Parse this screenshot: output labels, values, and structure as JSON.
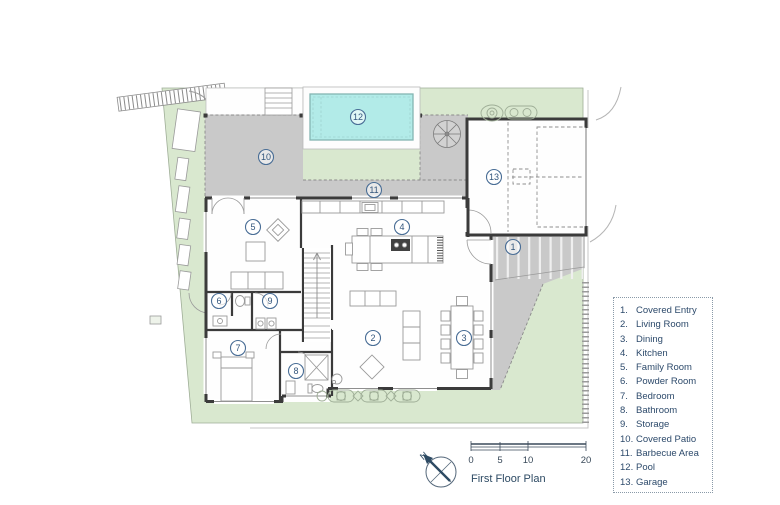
{
  "title": "First Floor Plan",
  "north_label": "N",
  "scalebar": {
    "ticks": [
      "0",
      "5",
      "10",
      "20"
    ]
  },
  "plan": {
    "labels": [
      {
        "number": "1",
        "name": "Covered Entry"
      },
      {
        "number": "2",
        "name": "Living Room"
      },
      {
        "number": "3",
        "name": "Dining"
      },
      {
        "number": "4",
        "name": "Kitchen"
      },
      {
        "number": "5",
        "name": "Family Room"
      },
      {
        "number": "6",
        "name": "Powder Room"
      },
      {
        "number": "7",
        "name": "Bedroom"
      },
      {
        "number": "8",
        "name": "Bathroom"
      },
      {
        "number": "9",
        "name": "Storage"
      },
      {
        "number": "10",
        "name": "Covered Patio"
      },
      {
        "number": "11",
        "name": "Barbecue Area"
      },
      {
        "number": "12",
        "name": "Pool"
      },
      {
        "number": "13",
        "name": "Garage"
      }
    ]
  },
  "legend": {
    "items": [
      {
        "number": "1.",
        "label": "Covered Entry"
      },
      {
        "number": "2.",
        "label": "Living Room"
      },
      {
        "number": "3.",
        "label": "Dining"
      },
      {
        "number": "4.",
        "label": "Kitchen"
      },
      {
        "number": "5.",
        "label": "Family Room"
      },
      {
        "number": "6.",
        "label": "Powder Room"
      },
      {
        "number": "7.",
        "label": "Bedroom"
      },
      {
        "number": "8.",
        "label": "Bathroom"
      },
      {
        "number": "9.",
        "label": "Storage"
      },
      {
        "number": "10.",
        "label": "Covered Patio"
      },
      {
        "number": "11.",
        "label": "Barbecue Area"
      },
      {
        "number": "12.",
        "label": "Pool"
      },
      {
        "number": "13.",
        "label": "Garage"
      }
    ]
  },
  "colors": {
    "lawn": "#d9e8cf",
    "paving": "#c9c9c9",
    "pool_water": "#b2ebe8",
    "wall": "#3b3b3b",
    "label_blue": "#33567c",
    "legend_text": "#2d4a6b"
  }
}
